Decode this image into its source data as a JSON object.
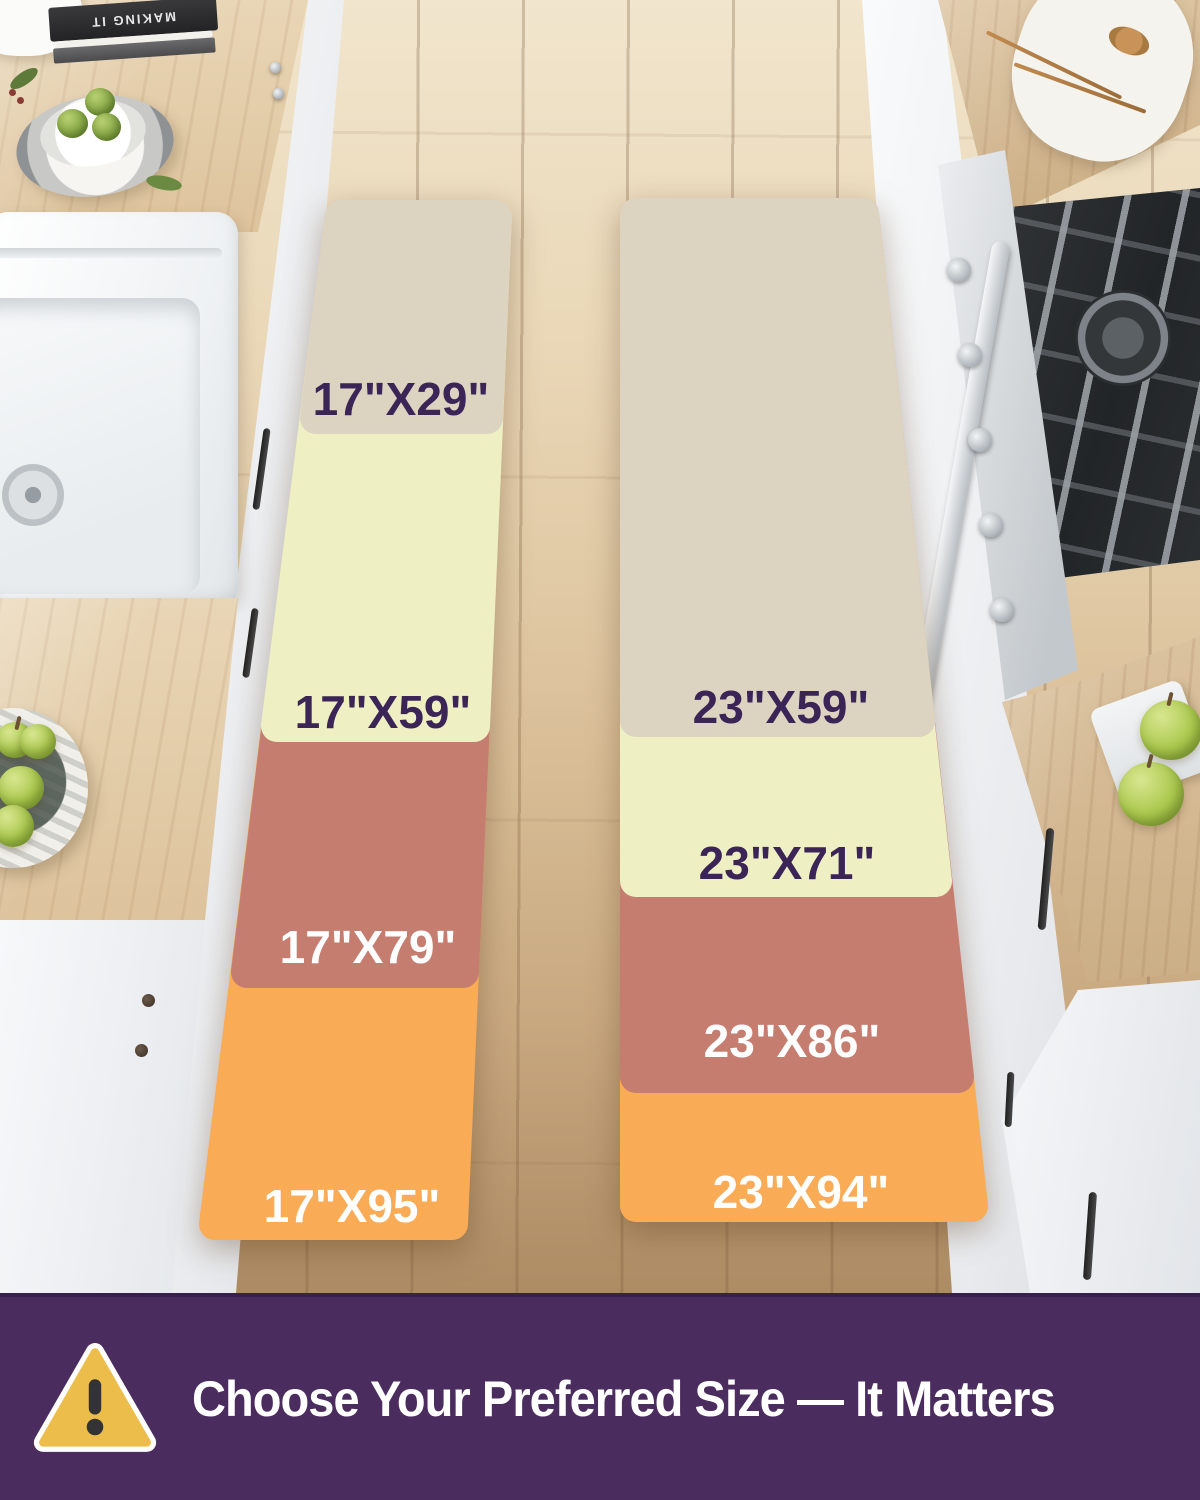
{
  "background": {
    "book_title": "MAKING IT"
  },
  "size_chart": {
    "left": {
      "sizes": [
        {
          "label": "17\"X29\"",
          "fill": "#dcd4c1",
          "text_color": "#3b2456"
        },
        {
          "label": "17\"X59\"",
          "fill": "#eef0c4",
          "text_color": "#3b2456"
        },
        {
          "label": "17\"X79\"",
          "fill": "#c57d70",
          "text_color": "#ffffff"
        },
        {
          "label": "17\"X95\"",
          "fill": "#f9ab55",
          "text_color": "#ffffff"
        }
      ]
    },
    "right": {
      "sizes": [
        {
          "label": "23\"X59\"",
          "fill": "#dcd4c1",
          "text_color": "#3b2456"
        },
        {
          "label": "23\"X71\"",
          "fill": "#eef0c4",
          "text_color": "#3b2456"
        },
        {
          "label": "23\"X86\"",
          "fill": "#c57d70",
          "text_color": "#ffffff"
        },
        {
          "label": "23\"X94\"",
          "fill": "#f9ab55",
          "text_color": "#ffffff"
        }
      ]
    }
  },
  "banner": {
    "text": "Choose Your Preferred Size — It Matters",
    "background": "#4a2c5e",
    "icon": "warning-triangle-icon",
    "icon_fill": "#edbd4c"
  }
}
